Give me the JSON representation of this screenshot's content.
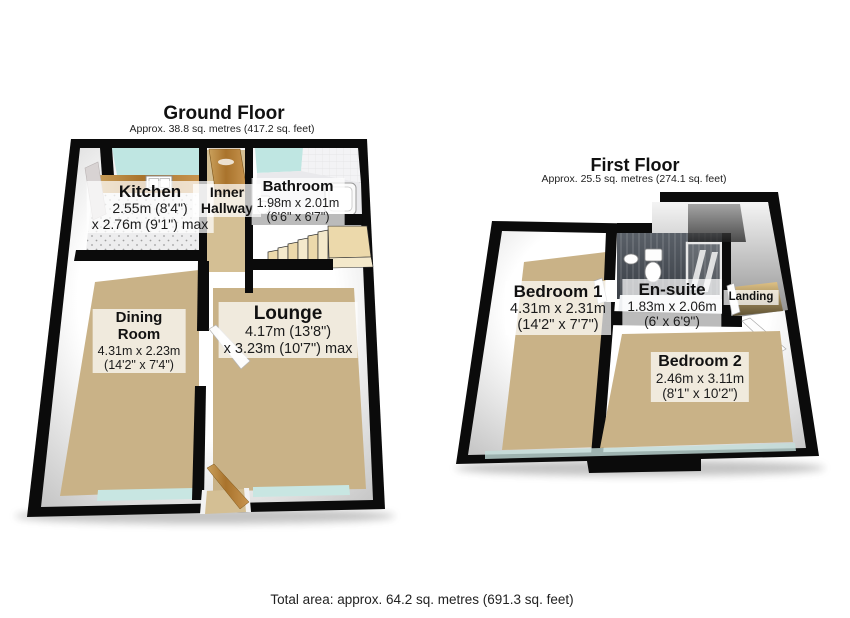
{
  "ground_floor": {
    "title": "Ground Floor",
    "subtitle": "Approx. 38.8 sq. metres (417.2 sq. feet)",
    "rooms": {
      "kitchen": {
        "name": "Kitchen",
        "dim1": "2.55m (8'4\")",
        "dim2": "x 2.76m (9'1\") max"
      },
      "inner_hallway": {
        "name": "Inner Hallway"
      },
      "bathroom": {
        "name": "Bathroom",
        "dim1": "1.98m x 2.01m",
        "dim2": "(6'6\" x 6'7\")"
      },
      "dining_room": {
        "name": "Dining Room",
        "dim1": "4.31m x 2.23m",
        "dim2": "(14'2\" x 7'4\")"
      },
      "lounge": {
        "name": "Lounge",
        "dim1": "4.17m (13'8\")",
        "dim2": "x 3.23m (10'7\") max"
      }
    }
  },
  "first_floor": {
    "title": "First Floor",
    "subtitle": "Approx. 25.5 sq. metres (274.1 sq. feet)",
    "rooms": {
      "bedroom_1": {
        "name": "Bedroom 1",
        "dim1": "4.31m x 2.31m",
        "dim2": "(14'2\" x 7'7\")"
      },
      "en_suite": {
        "name": "En-suite",
        "dim1": "1.83m x 2.06m",
        "dim2": "(6' x 6'9\")"
      },
      "landing": {
        "name": "Landing"
      },
      "bedroom_2": {
        "name": "Bedroom 2",
        "dim1": "2.46m x 3.11m",
        "dim2": "(8'1\" x 10'2\")"
      }
    }
  },
  "footer": {
    "total_area": "Total area: approx. 64.2 sq. metres (691.3 sq. feet)"
  },
  "colors": {
    "wall": "#0b0b0b",
    "carpet": "#c9b287",
    "hall_floor": "#d4bf94",
    "glass": "#bfe6e2",
    "glass_light": "#c8e6e2",
    "wood": "#b9803c",
    "stairs": "#ecd9ab",
    "stairs_light": "#f4e9cb",
    "tile_floor": "#ededee",
    "bath_floor": "#e9e9ec",
    "ensuite_wall": "#4a5058",
    "text": "#1a1a1a"
  }
}
